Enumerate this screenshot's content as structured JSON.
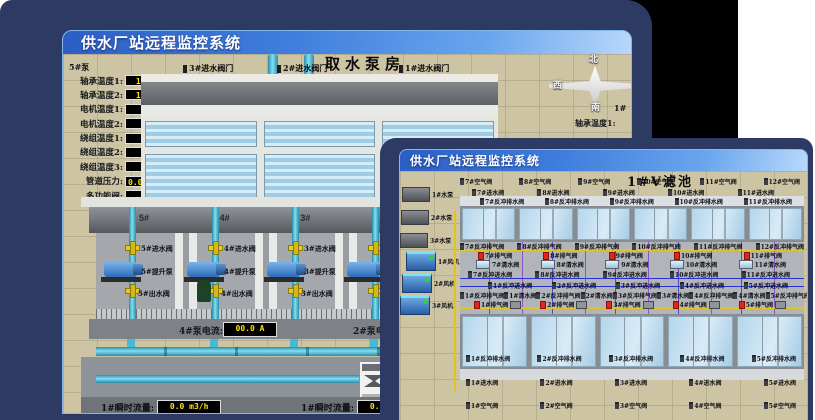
{
  "back_window": {
    "title": "供水厂站远程监控系统",
    "scene_title": "取水泵房",
    "pump5_panel": {
      "header": "5#泵",
      "rows": [
        {
          "label": "轴承温度1:",
          "value": "100.0℃"
        },
        {
          "label": "轴承温度2:",
          "value": "100.0℃"
        },
        {
          "label": "电机温度1:",
          "value": "18.1℃"
        },
        {
          "label": "电机温度2:",
          "value": "17.9℃"
        },
        {
          "label": "绕组温度1:",
          "value": "18.0℃"
        },
        {
          "label": "绕组温度2:",
          "value": "18.1℃"
        },
        {
          "label": "绕组温度3:",
          "value": "18.1℃"
        },
        {
          "label": "管道压力:",
          "value": "0.0007MPa"
        },
        {
          "label": "多功能阀:",
          "value": "0%"
        }
      ]
    },
    "inlet_valve_labels": [
      "3#进水阀门",
      "2#进水阀门",
      "1#进水阀门"
    ],
    "compass": {
      "north": "北",
      "west": "西",
      "south": "南"
    },
    "right_pump_header": "1#",
    "right_partial_labels": [
      "轴承温度1:",
      "轴承温度2:"
    ],
    "pump_room": {
      "bay_headers": [
        "5#",
        "4#",
        "3#",
        "2#"
      ],
      "assemblies": [
        {
          "inlet": "5#进水阀",
          "pump": "5#提升泵",
          "outlet": "5#出水阀"
        },
        {
          "inlet": "4#进水阀",
          "pump": "4#提升泵",
          "outlet": "4#出水阀"
        },
        {
          "inlet": "3#进水阀",
          "pump": "3#提升泵",
          "outlet": "3#出水阀"
        },
        {
          "inlet": "",
          "pump": "",
          "outlet": ""
        }
      ],
      "current_left": {
        "label": "4#泵电流:",
        "value": "00.0 A"
      },
      "current_right_label": "2#泵电流:"
    },
    "flow_left": {
      "label": "1#瞬时流量:",
      "value": "0.0 m3/h"
    },
    "flow_right": {
      "label": "1#瞬时流量:",
      "value": "0.0 m3/h"
    }
  },
  "front_window": {
    "title": "供水厂站远程监控系统",
    "scene_title": "1#V滤池",
    "equipment_pumps": [
      "1#水泵",
      "2#水泵",
      "3#水泵"
    ],
    "equipment_fans": [
      "1#风机",
      "2#风机",
      "3#风机"
    ],
    "row_air_top": [
      "7#空气阀",
      "8#空气阀",
      "9#空气阀",
      "10#空气阀",
      "11#空气阀",
      "12#空气阀"
    ],
    "row_inlet_top": [
      "7#进水阀",
      "8#进水阀",
      "9#进水阀",
      "10#进水阀",
      "11#进水阀"
    ],
    "row_bwdrain_top": [
      "7#反冲排水阀",
      "8#反冲排水阀",
      "9#反冲排水阀",
      "10#反冲排水阀",
      "11#反冲排水阀"
    ],
    "row_bwair_top": [
      "7#反冲排气阀",
      "8#反冲排气阀",
      "9#反冲排气阀",
      "10#反冲排气阀",
      "11#反冲排气阀",
      "12#反冲排气阀"
    ],
    "row_exhaust_top": [
      "7#排气阀",
      "8#排气阀",
      "9#排气阀",
      "10#排气阀",
      "11#排气阀"
    ],
    "row_clear_top": [
      "7#清水阀",
      "8#清水阀",
      "9#清水阀",
      "10#清水阀",
      "11#清水阀"
    ],
    "row_bwinlet_top": [
      "7#反冲进水阀",
      "8#反冲进水阀",
      "9#反冲进水阀",
      "10#反冲进水阀",
      "11#反冲进水阀"
    ],
    "row_bwinlet_bottom": [
      "1#反冲进水阀",
      "2#反冲进水阀",
      "3#反冲进水阀",
      "4#反冲进水阀",
      "5#反冲进水阀"
    ],
    "row_clear_bottom": [
      "1#反冲排气阀",
      "1#清水阀",
      "2#反冲排气阀",
      "2#清水阀",
      "3#反冲排气阀",
      "3#清水阀",
      "4#反冲排气阀",
      "4#清水阀",
      "5#反冲排气阀",
      "5#清水阀"
    ],
    "row_exhaust_bottom": [
      "1#排气阀",
      "2#排气阀",
      "3#排气阀",
      "4#排气阀",
      "5#排气阀"
    ],
    "row_bwdrain_bottom": [
      "1#反冲排水阀",
      "2#反冲排水阀",
      "3#反冲排水阀",
      "4#反冲排水阀",
      "5#反冲排水阀"
    ],
    "row_inlet_bottom": [
      "1#进水阀",
      "2#进水阀",
      "3#进水阀",
      "4#进水阀",
      "5#进水阀"
    ],
    "row_air_bottom": [
      "1#空气阀",
      "2#空气阀",
      "3#空气阀",
      "4#空气阀",
      "5#空气阀"
    ]
  },
  "colors": {
    "desktop_navy": "#2d3b64",
    "titlebar_blue": "#3f7edc",
    "scene_beige": "#cdc4a4",
    "readout_bg": "#000000",
    "readout_text": "#ffe000",
    "alarm_red": "#e02818",
    "pipe_cyan": "#49b8d8",
    "valve_yellow": "#e8cc18"
  }
}
